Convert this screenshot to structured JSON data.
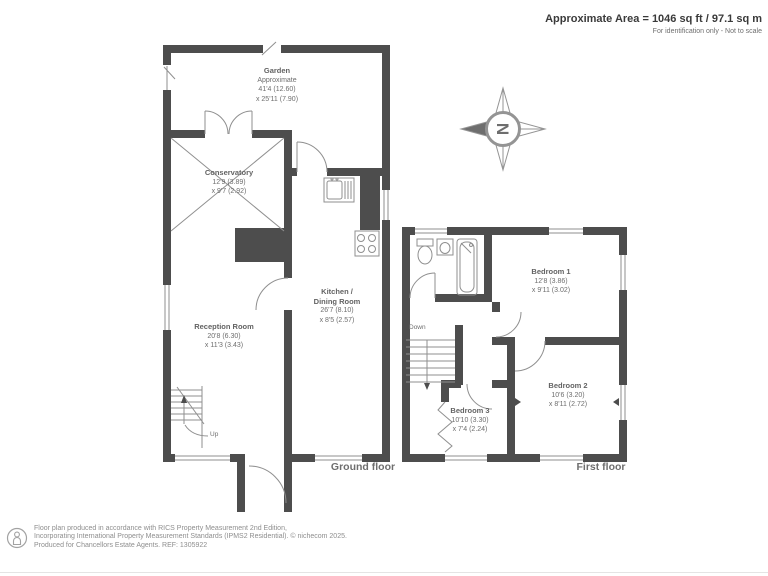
{
  "header": {
    "area_text": "Approximate Area = 1046 sq ft / 97.1 sq m",
    "disclaimer": "For identification only - Not to scale"
  },
  "ground_floor": {
    "label": "Ground floor",
    "garden": {
      "name": "Garden",
      "approx": "Approximate",
      "dim1": "41'4 (12.60)",
      "dim2": "x 25'11 (7.90)"
    },
    "conservatory": {
      "name": "Conservatory",
      "dim1": "12'9 (3.89)",
      "dim2": "x 9'7 (2.92)"
    },
    "reception": {
      "name": "Reception Room",
      "dim1": "20'8 (6.30)",
      "dim2": "x 11'3 (3.43)"
    },
    "kitchen": {
      "name_line1": "Kitchen /",
      "name_line2": "Dining Room",
      "dim1": "26'7 (8.10)",
      "dim2": "x 8'5 (2.57)"
    },
    "stairs_label": "Up"
  },
  "first_floor": {
    "label": "First floor",
    "bedroom1": {
      "name": "Bedroom 1",
      "dim1": "12'8 (3.86)",
      "dim2": "x 9'11 (3.02)"
    },
    "bedroom2": {
      "name": "Bedroom 2",
      "dim1": "10'6 (3.20)",
      "dim2": "x 8'11 (2.72)"
    },
    "bedroom3": {
      "name": "Bedroom 3",
      "dim1": "10'10 (3.30)",
      "dim2": "x 7'4 (2.24)"
    },
    "stairs_label": "Down"
  },
  "compass": {
    "letter": "N"
  },
  "footer": {
    "line1": "Floor plan produced in accordance with RICS Property Measurement 2nd Edition,",
    "line2": "Incorporating International Property Measurement Standards (IPMS2 Residential).   © nichecom 2025.",
    "line3": "Produced for Chancellors Estate Agents.   REF:  1305922"
  },
  "colors": {
    "wall": "#4d4d4d",
    "line": "#8f8f8f",
    "text": "#6e6e6e"
  }
}
